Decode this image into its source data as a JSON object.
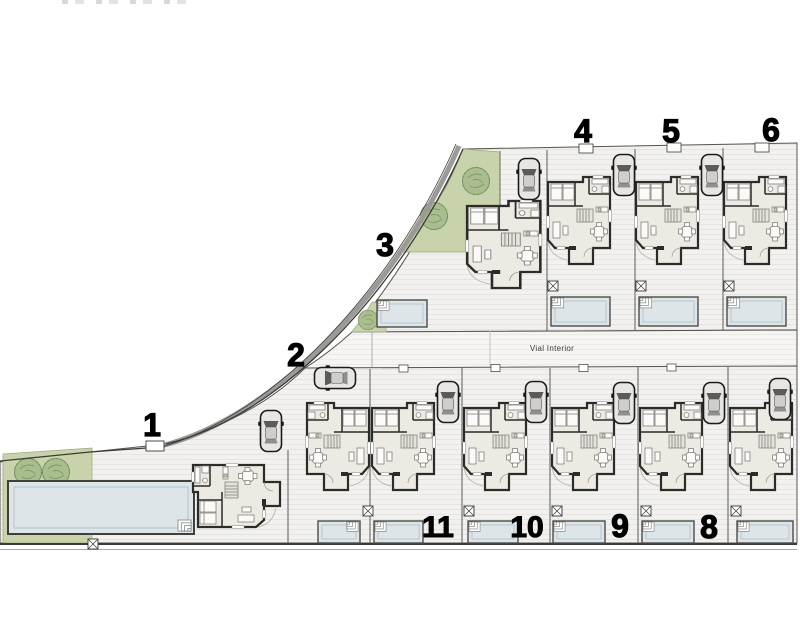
{
  "plan": {
    "road_label": "Vial Interior",
    "units": [
      {
        "id": "villa-1",
        "number": "1"
      },
      {
        "id": "villa-2",
        "number": "2"
      },
      {
        "id": "villa-3",
        "number": "3"
      },
      {
        "id": "villa-4",
        "number": "4"
      },
      {
        "id": "villa-5",
        "number": "5"
      },
      {
        "id": "villa-6",
        "number": "6"
      },
      {
        "id": "villa-8",
        "number": "8"
      },
      {
        "id": "villa-9",
        "number": "9"
      },
      {
        "id": "villa-10",
        "number": "10"
      },
      {
        "id": "villa-11",
        "number": "11"
      }
    ],
    "colors": {
      "lawn": "#c9d3ab",
      "tree": "#a9bd8e",
      "pool_water": "#dde5e9",
      "wall": "#2b2b29",
      "floor": "#edeae4",
      "paving": "#f2f1ef",
      "paving_line": "#e3e2df",
      "boundary": "#4a4a46",
      "label": "#000000"
    }
  }
}
